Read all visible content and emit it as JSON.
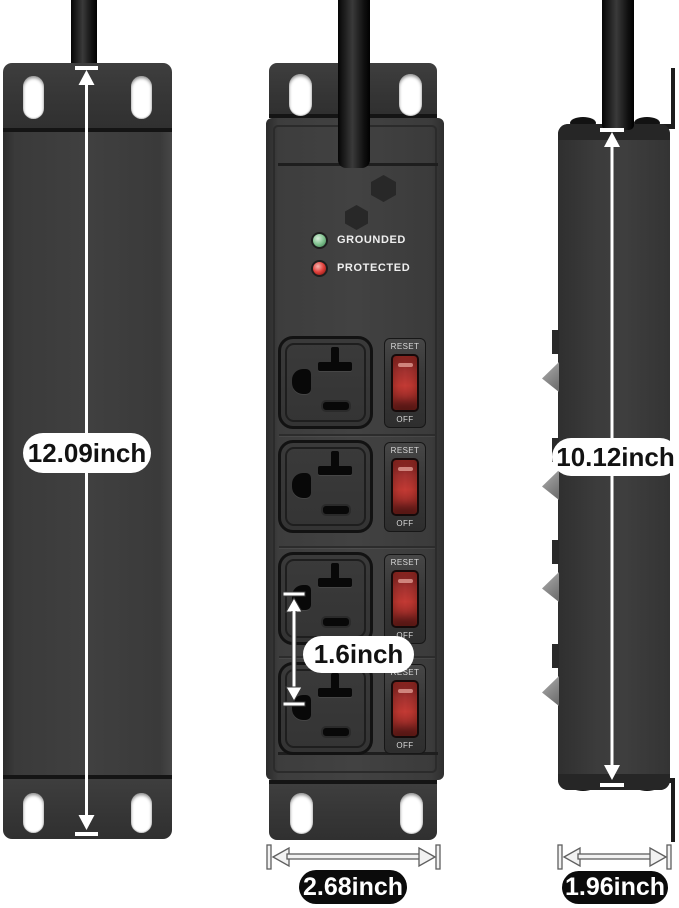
{
  "annotations": {
    "back_height": "12.09inch",
    "outlet_spacing": "1.6inch",
    "front_width": "2.68inch",
    "side_height": "10.12inch",
    "side_width": "1.96inch"
  },
  "front_panel": {
    "grounded_label": "GROUNDED",
    "protected_label": "PROTECTED",
    "switch_reset_label": "RESET",
    "switch_off_label": "OFF"
  },
  "colors": {
    "background": "#ffffff",
    "chassis_gray": "#3c3c3c",
    "cable_black": "#161616",
    "led_grounded_green": "#7fc48d",
    "led_protected_red": "#e2413c",
    "switch_glow_red": "#c23a34",
    "dimension_pill_light_bg": "#ffffff",
    "dimension_pill_light_text": "#121212",
    "dimension_pill_dark_bg": "#0b0b0b",
    "dimension_pill_dark_text": "#ffffff",
    "dimension_arrow": "#ffffff"
  }
}
